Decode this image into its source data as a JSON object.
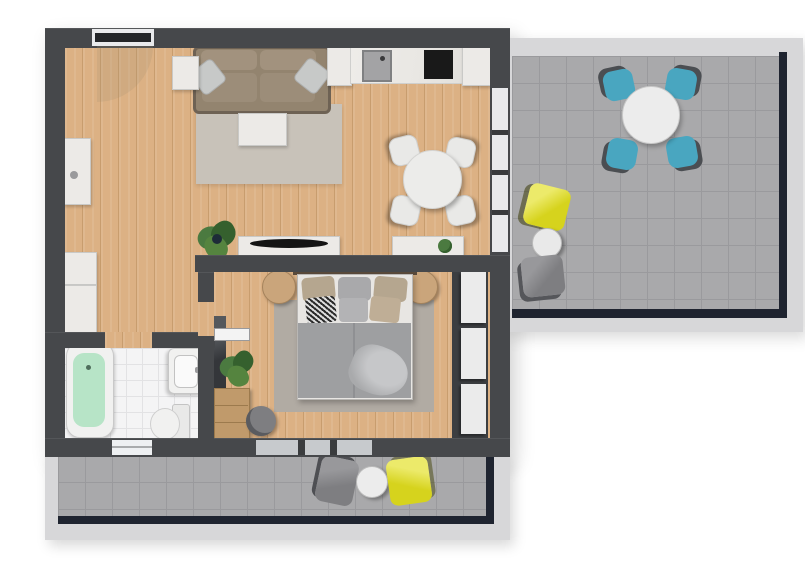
{
  "title": "3D apartment floor plan, top-down view",
  "colors": {
    "wall": "#46484b",
    "wood": "#dcb184",
    "wood_line": "#c89d6e",
    "tile": "#a9a9ab",
    "tile_line": "#9a9a9d",
    "railing": "#d7d7d9",
    "navy_edge": "#1f2430",
    "window_glass": "#e9eaec",
    "sliding_glass": "#c7cacd",
    "rug_living": "#c8c2b9",
    "rug_bedroom": "#b1aba3",
    "sofa_body": "#93846f",
    "sofa_frame": "#6e6254",
    "sofa_cushion": "#a2927e",
    "pillow_gray": "#c7c9c8",
    "white_furniture": "#eceae7",
    "furniture_border": "#c9c9c7",
    "counter_marble": "#e9e7e3",
    "sink_gray": "#a3a3a5",
    "cooktop_black": "#191919",
    "tv_black": "#141414",
    "duvet_gray": "#9e9fa1",
    "headboard_brown": "#5a4a3b",
    "pillow_beige": "#b5a68f",
    "pillow_tan": "#bfae96",
    "wood_table": "#caa57b",
    "wardrobe_frame": "#3c3e41",
    "wardrobe_panel": "#ebebeb",
    "bath_floor": "#f4f4f5",
    "bath_water": "#b7e4c7",
    "fixture_white": "#f1f1f0",
    "chair_teal": "#49a6c0",
    "chair_yellow": "#d6d31d",
    "chair_gray": "#7e7e81",
    "plant_green": "#4b7a40",
    "plant_dark": "#35602e",
    "door_leaf_dark": "#232528"
  },
  "scene": {
    "rooms": [
      {
        "name": "living-room-kitchen",
        "floor": "wood"
      },
      {
        "name": "hallway",
        "floor": "wood"
      },
      {
        "name": "bedroom",
        "floor": "wood"
      },
      {
        "name": "bathroom",
        "floor": "white-tile"
      },
      {
        "name": "terrace-right",
        "floor": "gray-tile"
      },
      {
        "name": "terrace-bottom",
        "floor": "gray-tile"
      }
    ],
    "furniture": {
      "living_room": [
        "sofa with two gray pillows",
        "side table",
        "area rug",
        "coffee table",
        "round dining table with four white chairs",
        "kitchen counter with sink and cooktop",
        "two kitchen cabinets",
        "tall white cabinet",
        "two hall cabinets",
        "TV sideboard with curved TV",
        "console table with small plant",
        "large potted plant",
        "entrance door"
      ],
      "bedroom": [
        "double bed with gray duvet and six pillows",
        "headboard",
        "two round nightstands",
        "area rug",
        "built-in wardrobe with three white panels",
        "dark mirror panel",
        "potted plant",
        "wooden dresser",
        "round gray pouf",
        "door leaf"
      ],
      "bathroom": [
        "bathtub with green water",
        "wall washbasin",
        "toilet",
        "window"
      ],
      "terrace_right": [
        "round white dining table",
        "four teal chairs",
        "yellow lounge chair",
        "round side table",
        "gray lounge chair"
      ],
      "terrace_bottom": [
        "gray lounge chair",
        "round side table",
        "yellow lounge chair"
      ]
    }
  }
}
